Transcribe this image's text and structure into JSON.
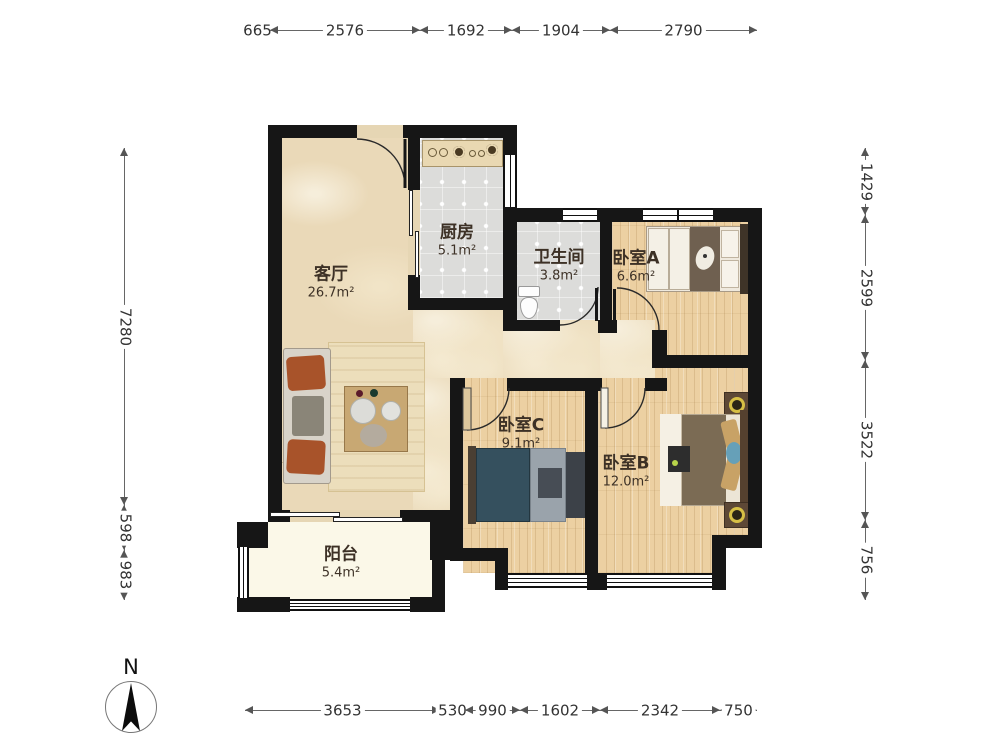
{
  "rooms": [
    {
      "id": "living",
      "name": "客厅",
      "area": "26.7m²"
    },
    {
      "id": "kitchen",
      "name": "厨房",
      "area": "5.1m²"
    },
    {
      "id": "bathroom",
      "name": "卫生间",
      "area": "3.8m²"
    },
    {
      "id": "bedroom-a",
      "name": "卧室A",
      "area": "6.6m²"
    },
    {
      "id": "bedroom-c",
      "name": "卧室C",
      "area": "9.1m²"
    },
    {
      "id": "bedroom-b",
      "name": "卧室B",
      "area": "12.0m²"
    },
    {
      "id": "balcony",
      "name": "阳台",
      "area": "5.4m²"
    }
  ],
  "dimensions": {
    "top": [
      "665",
      "2576",
      "1692",
      "1904",
      "2790"
    ],
    "bottom": [
      "3653",
      "530",
      "990",
      "1602",
      "2342",
      "750"
    ],
    "left": [
      "7280",
      "598",
      "983"
    ],
    "right": [
      "1429",
      "2599",
      "3522",
      "756"
    ]
  },
  "compass": {
    "north_label": "N"
  },
  "colors": {
    "wall": "#161616",
    "marble_floor": "#ead9b8",
    "wood_floor": "#ecd0a2",
    "tile_floor": "#dcdcda",
    "balcony_floor": "#fbf8e8",
    "dimension_text": "#333333"
  }
}
